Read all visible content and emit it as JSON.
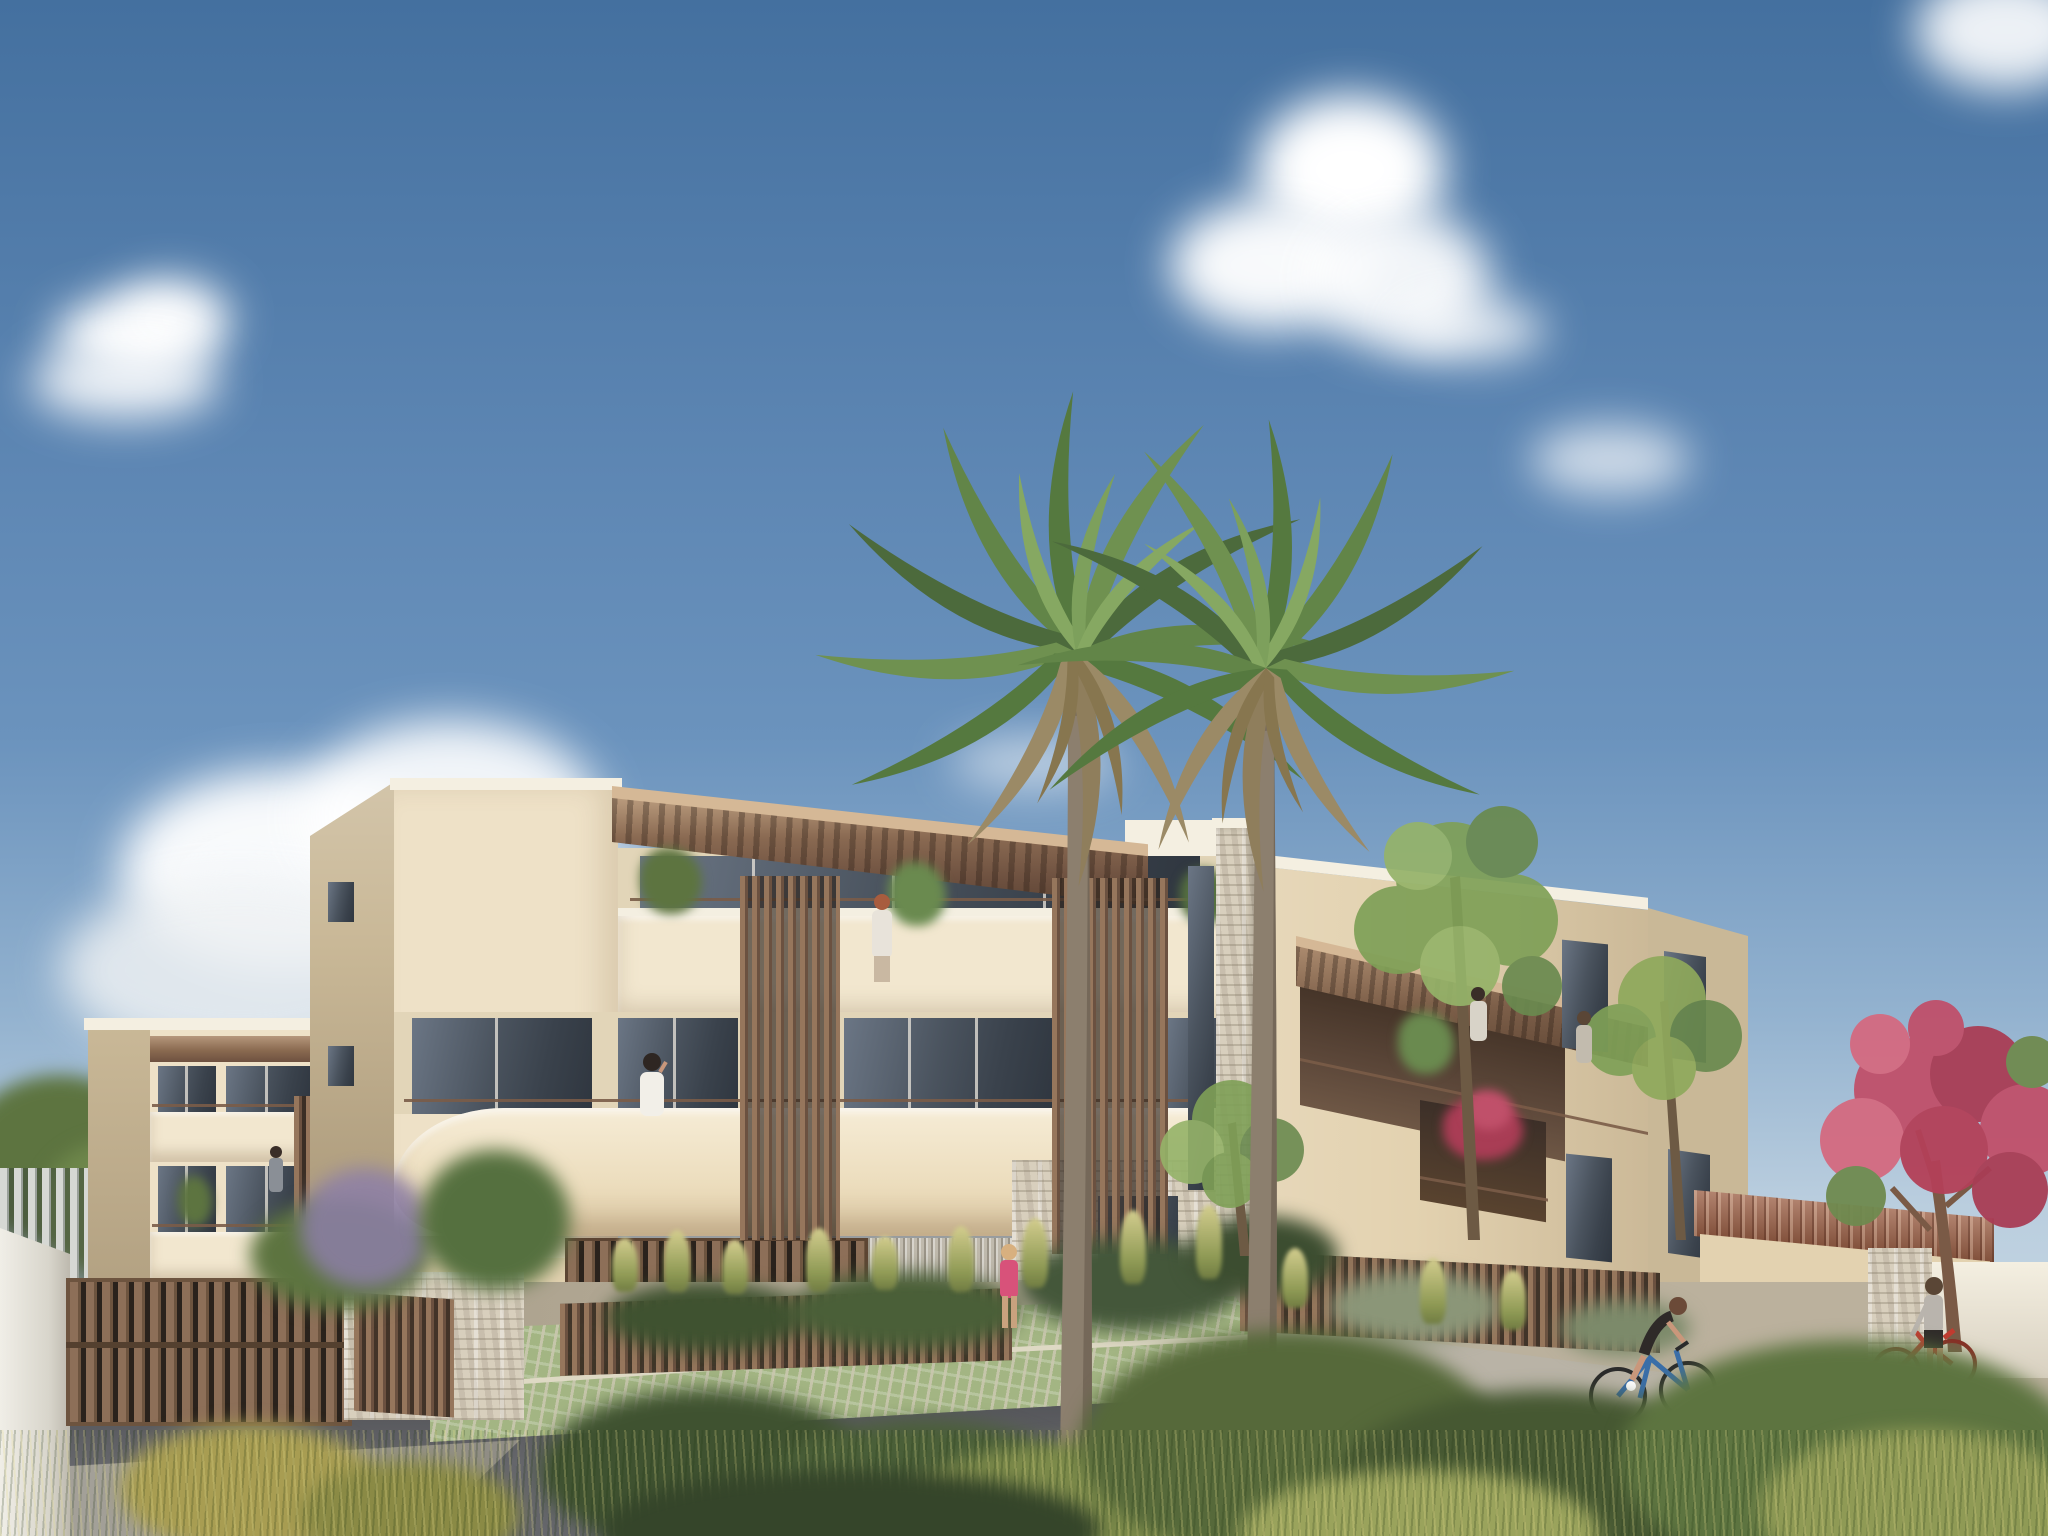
{
  "meta": {
    "image_type": "architectural-exterior-rendering",
    "description": "Sunny street view of a new three-storey cream stucco apartment residence with rounded balconies, timber slat screens, rooftop pergola terraces, stone-clad accents, two tall fan palms, landscaped wild garden, cyclist and pedestrians",
    "canvas": {
      "width": 2048,
      "height": 1536
    }
  },
  "palette": {
    "sky_top": "#44709f",
    "sky_mid": "#6b93bd",
    "sky_horizon": "#c6d7e3",
    "cloud_white": "#ffffff",
    "facade_cream": "#eee1c7",
    "facade_side": "#c9b897",
    "facade_tan": "#e3d2b0",
    "attic_wall": "#e2d5b8",
    "coping_white": "#f4efe1",
    "parapet_light": "#f2e7cf",
    "wood_slat": "#7d5f49",
    "wood_slat_dark": "#5d4533",
    "pergola_underside": "#6e5140",
    "pergola_fascia": "#d5b896",
    "cladding_gray": "#b5ae9f",
    "stone_light": "#d8cfbd",
    "glass_dark": "#3e464f",
    "asphalt": "#54555a",
    "path_light": "#b9b3a6",
    "paver_green": "#a3b583",
    "ground_tan": "#b3a892",
    "foliage_dark": "#3f5230",
    "foliage_mid": "#5d7440",
    "foliage_light": "#8fa95c",
    "grass_dry": "#b3ac62",
    "palm_green": "#55793f",
    "palm_dry": "#9b8a66",
    "trunk_gray": "#8c7f6e",
    "flower_pink": "#c0506a",
    "lavender": "#9a86b8",
    "roof_terracotta": "#9c6046",
    "bike_red": "#c23b30",
    "bike_blue": "#3a6ea8",
    "skin": "#c9977b"
  },
  "scene": {
    "setting": "new low-rise residential development on a bright day, viewed from the landscaped street corner",
    "sky": {
      "condition": "clear blue with scattered cumulus clouds",
      "cloud_clusters": 6
    },
    "buildings": [
      {
        "id": "left-wing",
        "floors": 3,
        "features": [
          "cream balconies with metal railings",
          "brown timber awning",
          "resident on balcony",
          "timber slat divider"
        ]
      },
      {
        "id": "main-block",
        "floors": 3,
        "features": [
          "rounded cream balcony bands",
          "double-height timber slat screens",
          "rooftop terrace with large timber pergola",
          "grey timber-clad ground floor",
          "timber louvred garage screen",
          "dry-stone clad pier and base",
          "residents on balconies",
          "potted plants"
        ]
      },
      {
        "id": "right-wing",
        "floors": 3,
        "features": [
          "recessed terraces under sloping pergola",
          "red flowering balcony",
          "tall windows",
          "residents on terrace"
        ]
      },
      {
        "id": "garden-annex",
        "floors": 1,
        "features": [
          "terracotta tile roof",
          "timber slat fence",
          "stone pier"
        ]
      }
    ],
    "vegetation": [
      "two tall fan palm trees",
      "ornamental dry grasses",
      "clipped green hedges",
      "airy green street trees",
      "pink flowering tree",
      "purple lavender shrub",
      "wild meadow foreground with yellow-green shrubs"
    ],
    "people": [
      {
        "id": "balcony-resident-left",
        "where": "left wing middle balcony"
      },
      {
        "id": "rooftop-resident",
        "where": "main block rooftop terrace, red hair, light top"
      },
      {
        "id": "balcony-resident-main",
        "where": "main block first floor balcony, white top, on phone"
      },
      {
        "id": "terrace-resident-right-1",
        "where": "right wing pergola terrace"
      },
      {
        "id": "terrace-resident-right-2",
        "where": "right wing pergola terrace"
      },
      {
        "id": "walker-pink-top",
        "where": "front garden walkway, blonde, pink top"
      },
      {
        "id": "cyclist",
        "where": "street, riding a blue bicycle, black sportswear"
      },
      {
        "id": "pedestrian-with-red-bike",
        "where": "standing by stone pier with red bicycle"
      }
    ],
    "objects": [
      "timber vehicle gate",
      "white stucco gate pillar",
      "dry-stone garden walls",
      "grass-grid parking pavers",
      "dark asphalt driveway",
      "light concrete path",
      "blue bicycle",
      "red bicycle"
    ]
  }
}
